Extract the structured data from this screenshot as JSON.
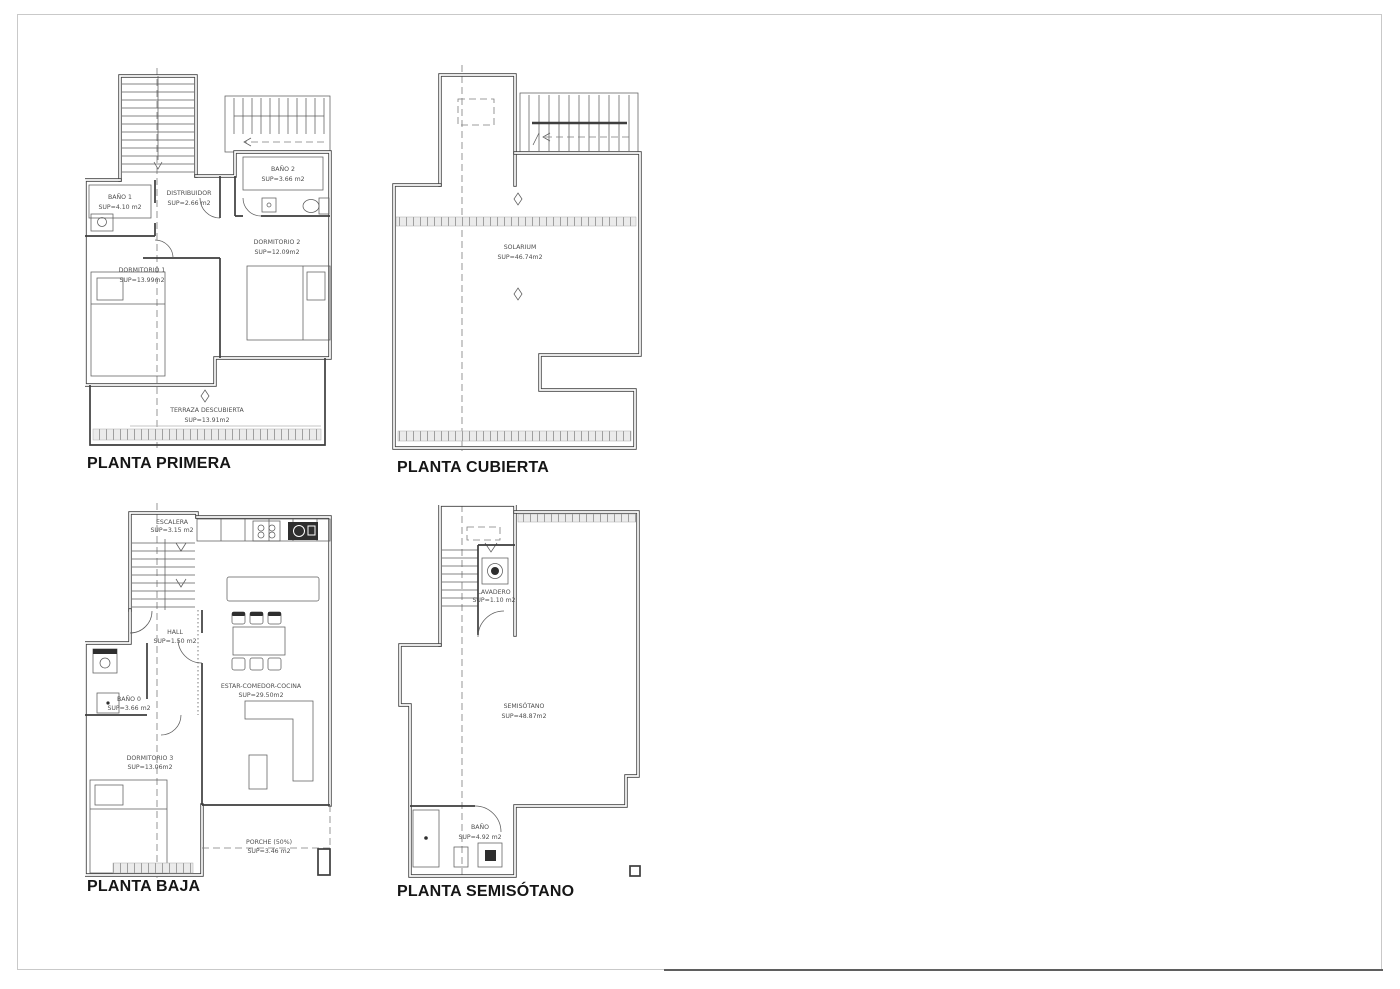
{
  "sheet": {
    "background": "#ffffff",
    "border_color": "#c9c9c9",
    "line_color": "#3d3d3d"
  },
  "plans": [
    {
      "id": "planta-primera",
      "title": "PLANTA PRIMERA",
      "rooms": [
        {
          "name": "BAÑO 1",
          "area": "SUP=4.10 m2"
        },
        {
          "name": "DISTRIBUIDOR",
          "area": "SUP=2.66 m2"
        },
        {
          "name": "BAÑO 2",
          "area": "SUP=3.66 m2"
        },
        {
          "name": "DORMITORIO 1",
          "area": "SUP=13.99m2"
        },
        {
          "name": "DORMITORIO 2",
          "area": "SUP=12.09m2"
        },
        {
          "name": "TERRAZA DESCUBIERTA",
          "area": "SUP=13.91m2"
        }
      ]
    },
    {
      "id": "planta-cubierta",
      "title": "PLANTA CUBIERTA",
      "rooms": [
        {
          "name": "SOLARIUM",
          "area": "SUP=46.74m2"
        }
      ]
    },
    {
      "id": "planta-baja",
      "title": "PLANTA BAJA",
      "rooms": [
        {
          "name": "ESCALERA",
          "area": "SUP=3.15 m2"
        },
        {
          "name": "HALL",
          "area": "SUP=1.50 m2"
        },
        {
          "name": "BAÑO 0",
          "area": "SUP=3.66 m2"
        },
        {
          "name": "DORMITORIO 3",
          "area": "SUP=13.06m2"
        },
        {
          "name": "ESTAR-COMEDOR-COCINA",
          "area": "SUP=29.50m2"
        },
        {
          "name": "PORCHE (50%)",
          "area": "SUP=3.46 m2"
        }
      ]
    },
    {
      "id": "planta-semisotano",
      "title": "PLANTA SEMISÓTANO",
      "rooms": [
        {
          "name": "LAVADERO",
          "area": "SUP=1.10 m2"
        },
        {
          "name": "SEMISÓTANO",
          "area": "SUP=48.87m2"
        },
        {
          "name": "BAÑO",
          "area": "SUP=4.92 m2"
        }
      ]
    }
  ]
}
